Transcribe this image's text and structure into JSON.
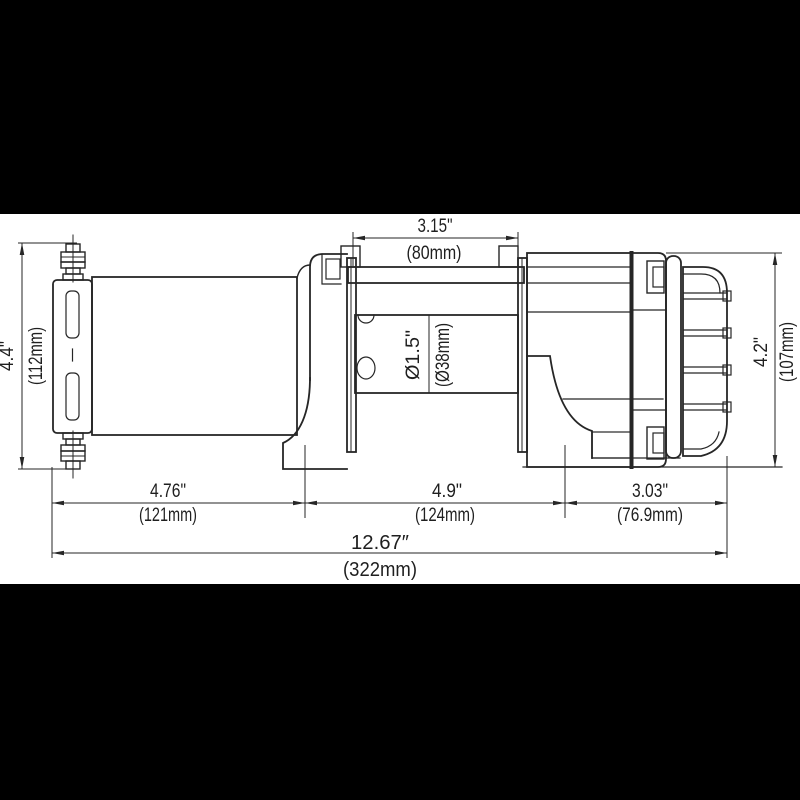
{
  "document": {
    "type": "technical-drawing",
    "subject": "Electric winch side elevation with mounting dimensions",
    "background": "#ffffff",
    "letterbox_color": "#000000",
    "line_color": "#262626"
  },
  "dims": {
    "drum_width": {
      "in": "3.15\"",
      "mm": "(80mm)"
    },
    "motor_height": {
      "in": "4.4\"",
      "mm": "(112mm)"
    },
    "drum_diameter": {
      "in": "Ø1.5\"",
      "mm": "(Ø38mm)"
    },
    "gearbox_height": {
      "in": "4.2\"",
      "mm": "(107mm)"
    },
    "motor_length": {
      "in": "4.76\"",
      "mm": "(121mm)"
    },
    "bolt_spacing": {
      "in": "4.9\"",
      "mm": "(124mm)"
    },
    "gearbox_length": {
      "in": "3.03\"",
      "mm": "(76.9mm)"
    },
    "overall_length": {
      "in": "12.67″",
      "mm": "(322mm)"
    }
  }
}
